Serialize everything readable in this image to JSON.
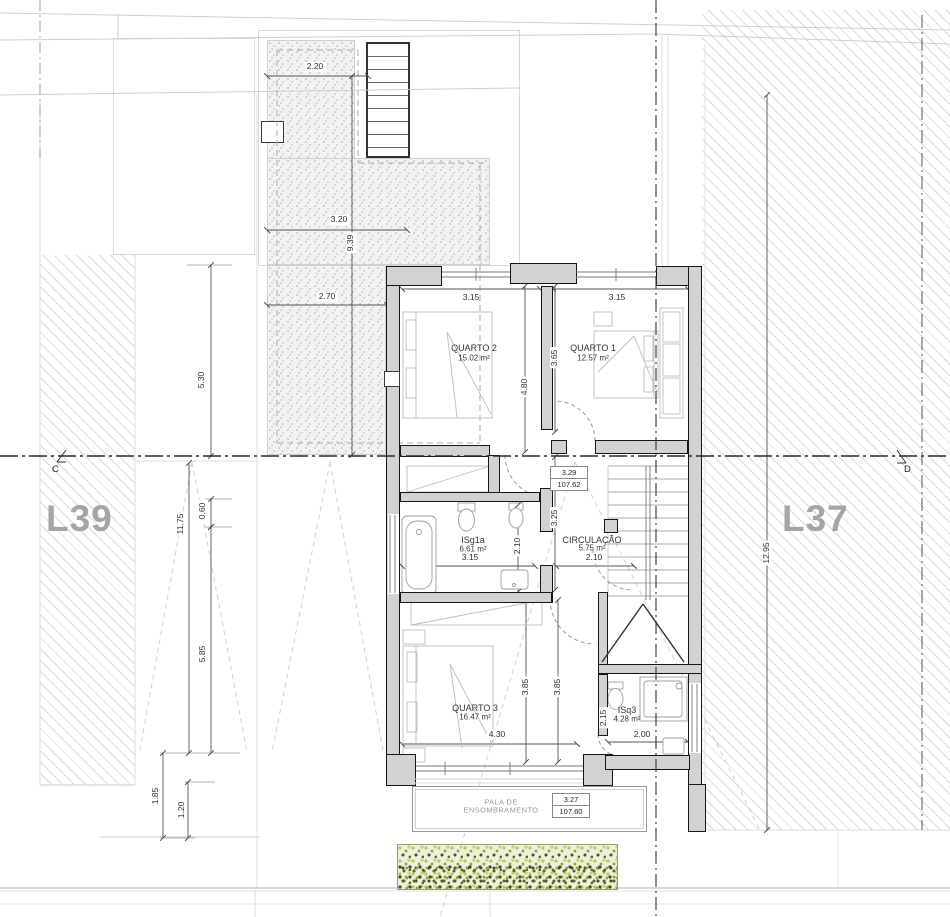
{
  "lots": {
    "left": "L39",
    "right": "L37"
  },
  "section": {
    "left": "C",
    "right": "D"
  },
  "rooms": {
    "quarto2": {
      "name": "QUARTO 2",
      "area": "15.02 m²"
    },
    "quarto1": {
      "name": "QUARTO 1",
      "area": "12.57 m²"
    },
    "isg1a": {
      "name": "ISg1a",
      "area": "6.61 m²"
    },
    "circulacao": {
      "name": "CIRCULAÇÃO",
      "area": "5.75 m²"
    },
    "quarto3": {
      "name": "QUARTO 3",
      "area": "16.47 m²"
    },
    "isq3": {
      "name": "ISq3",
      "area": "4.28 m²"
    }
  },
  "pala": {
    "line1": "PALA DE",
    "line2": "ENSOMBRAMENTO"
  },
  "levels": {
    "upper": {
      "value": "3.29",
      "elevation": "107.62"
    },
    "lower": {
      "value": "3.27",
      "elevation": "107.60"
    }
  },
  "dims": {
    "patio_top": "2.20",
    "patio_mid": "3.20",
    "patio_len": "9.39",
    "patio_low": "2.70",
    "left_a": "5.30",
    "left_b": "11.75",
    "left_c": "0.60",
    "left_d": "5.85",
    "left_e": "1.85",
    "left_f": "1.20",
    "q2_w": "3.15",
    "q1_w": "3.15",
    "q2_d": "4.80",
    "q1_d": "3.65",
    "hall_d": "3.25",
    "bath_d": "2.10",
    "bath_w": "3.15",
    "circ_w": "2.10",
    "q3_d1": "3.85",
    "q3_d2": "3.85",
    "q3_w": "4.30",
    "isq3_d": "2.15",
    "isq3_w": "2.00",
    "lot_right": "12.95"
  },
  "colors": {
    "wall_fill": "#d2d2d2",
    "wall_line": "#161616",
    "hatch_line": "#dadada",
    "lot_label": "#a5a5a5",
    "dim_text": "#2e2e2e",
    "veg_light": "#b5c85e",
    "veg_dark": "#44531f",
    "stipple_dot": "#bbbbbb"
  }
}
